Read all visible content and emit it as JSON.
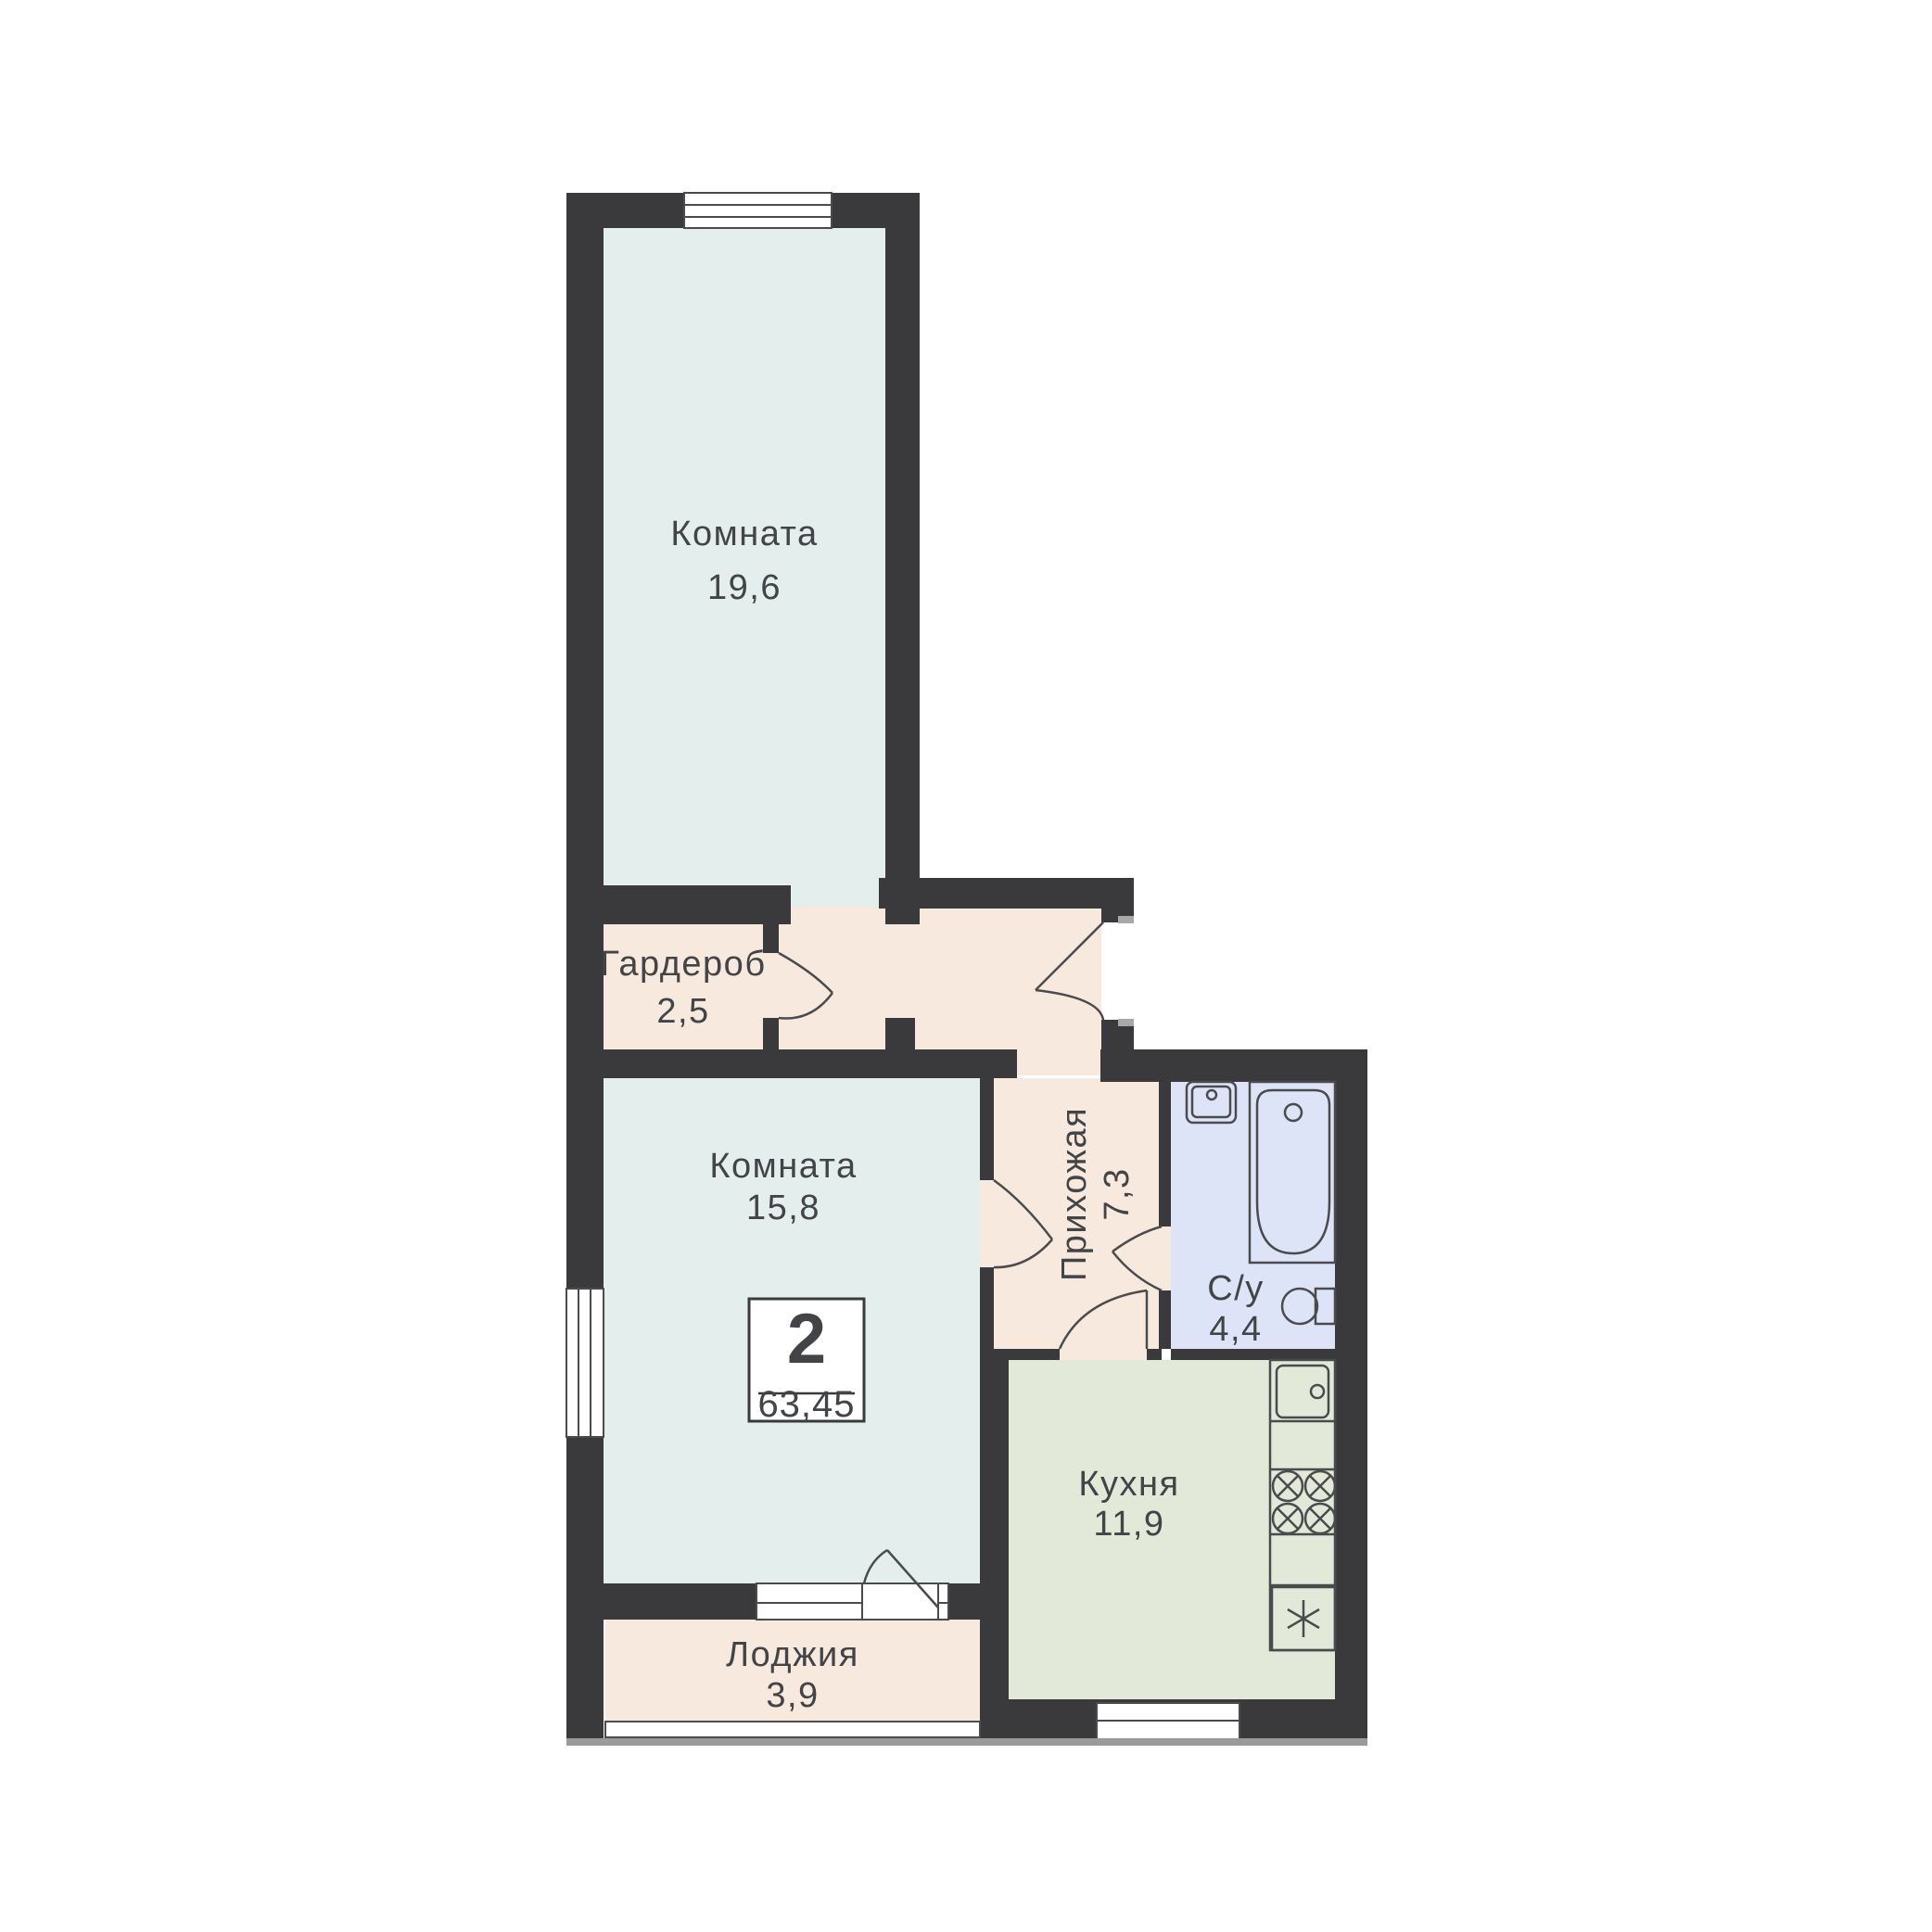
{
  "plan": {
    "badge": {
      "rooms_count": "2",
      "total_area": "63,45"
    },
    "rooms": [
      {
        "name": "Комната",
        "area": "19,6"
      },
      {
        "name": "Гардероб",
        "area": "2,5"
      },
      {
        "name": "Комната",
        "area": "15,8"
      },
      {
        "name": "Прихожая",
        "area": "7,3"
      },
      {
        "name": "С/у",
        "area": "4,4"
      },
      {
        "name": "Кухня",
        "area": "11,9"
      },
      {
        "name": "Лоджия",
        "area": "3,9"
      }
    ],
    "colors": {
      "wall": "#3a3a3c",
      "living_room_fill": "#e4efed",
      "hallway_fill": "#f8e9de",
      "bathroom_fill": "#dee4f7",
      "kitchen_fill": "#e2e9d8",
      "fixture_outline": "#4b4b4e",
      "label_text": "#424448",
      "balcony_rail_gray": "#9a9a9a",
      "background": "#ffffff"
    },
    "icons": {
      "fixtures": [
        "bathtub-icon",
        "bath-sink-icon",
        "toilet-icon",
        "kitchen-sink-icon",
        "stove-burners-icon",
        "fridge-icon"
      ],
      "symbols": [
        "door-swing-arc",
        "window-glazing"
      ]
    }
  }
}
